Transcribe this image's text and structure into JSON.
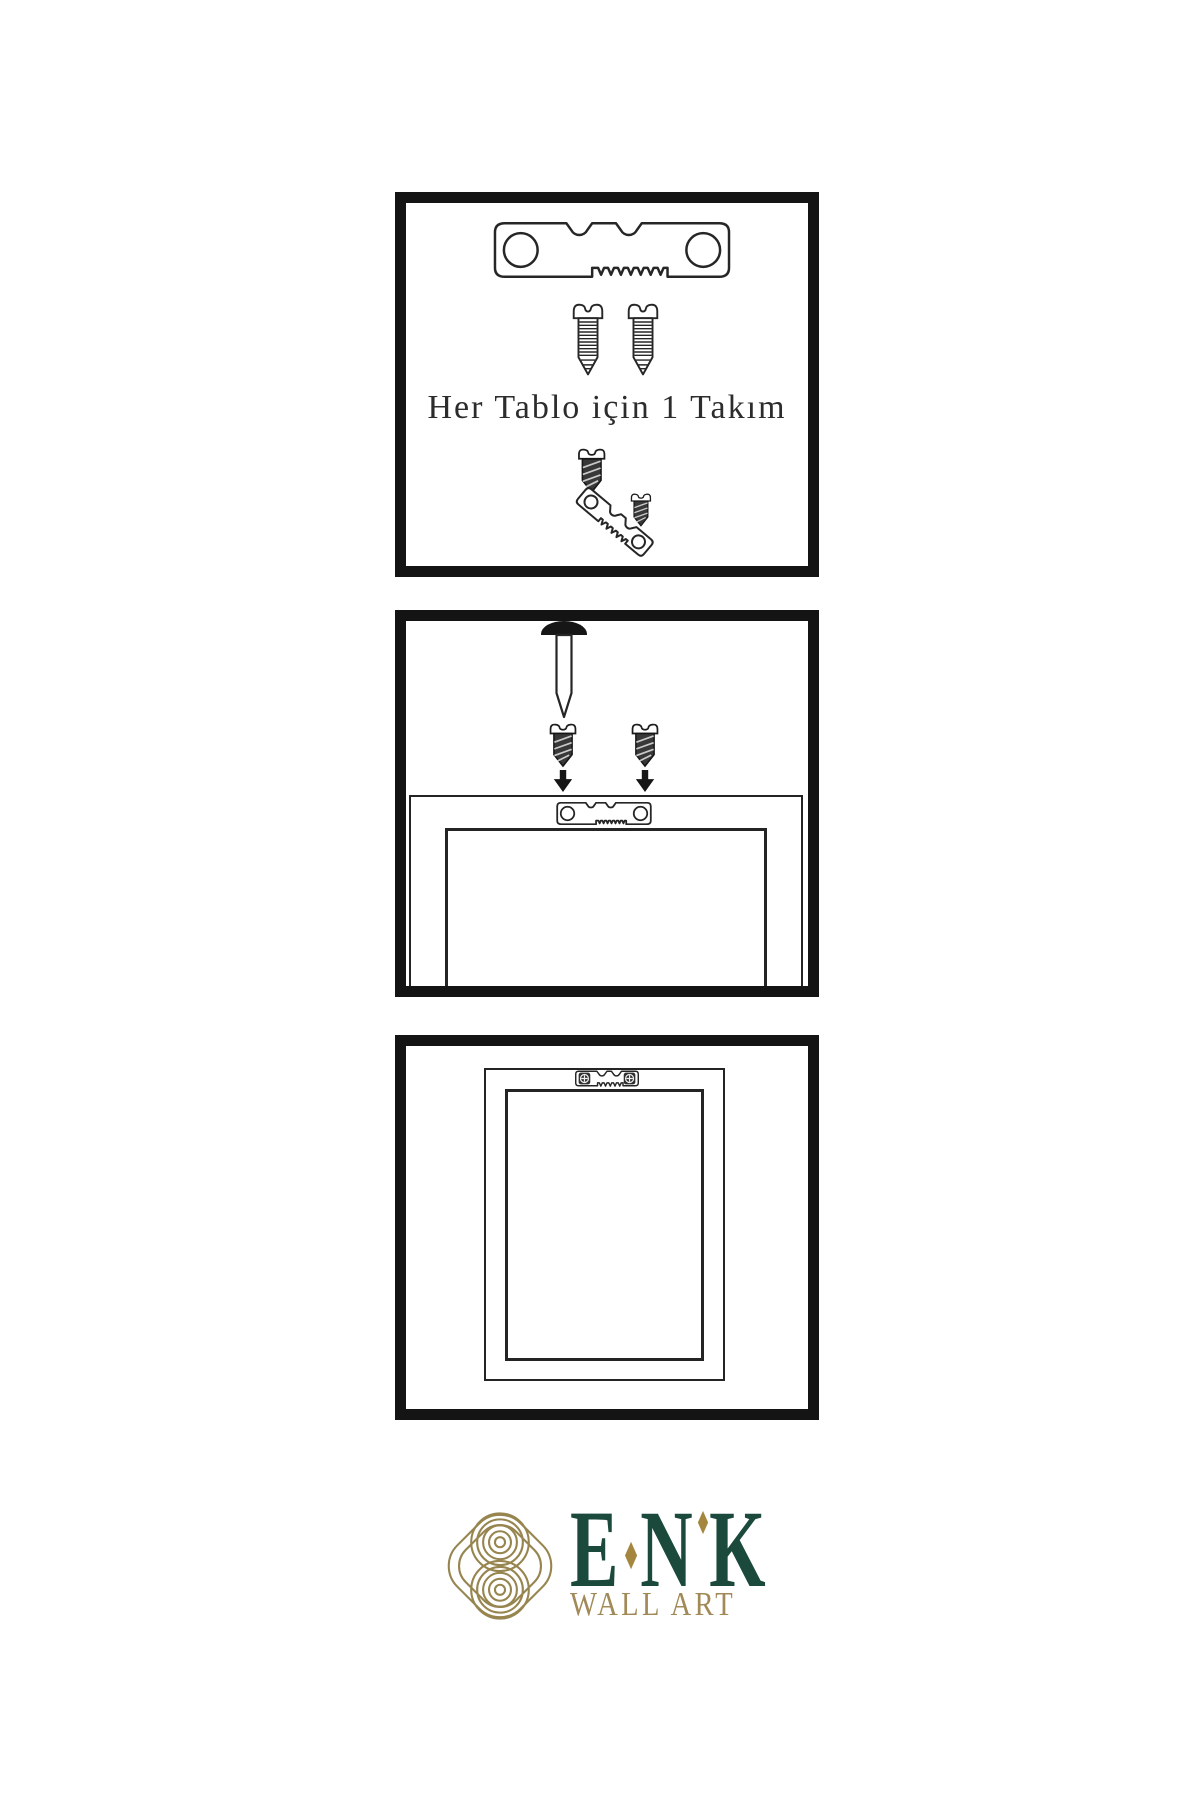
{
  "sheet": {
    "background": "#ffffff",
    "steps": [
      {
        "name": "hardware-kit",
        "caption": "Her Tablo için 1 Takım",
        "contents": [
          "sawtooth-hanger-icon",
          "screw-icon",
          "screw-icon",
          "screw-icon",
          "sawtooth-hanger-angled-icon",
          "screw-icon"
        ]
      },
      {
        "name": "attach-hanger-to-frame-back",
        "contents": [
          "nail-icon",
          "screw-icon",
          "screw-icon",
          "arrow-down-icon",
          "arrow-down-icon",
          "sawtooth-hanger-icon",
          "frame-back"
        ]
      },
      {
        "name": "frame-back-with-mounted-hanger",
        "contents": [
          "frame-back",
          "mounted-sawtooth-hanger-icon"
        ]
      }
    ]
  },
  "logo": {
    "letters": [
      "E",
      "N",
      "K"
    ],
    "subtitle": "WALL ART",
    "emblem": "knot-logo-icon"
  },
  "colors": {
    "panel_border": "#141414",
    "line_art": "#262626",
    "screw_dark_fill": "#383838",
    "caption_text": "#2c2c2c",
    "logo_green": "#1b4a3c",
    "logo_gold": "#a18a58",
    "logo_knot_gold": "#97854f",
    "logo_diamond_gold": "#a5863e",
    "background": "#ffffff"
  },
  "icons": {
    "sawtooth_hanger": "sawtooth-hanger-icon",
    "screw": "screw-icon",
    "nail": "nail-icon",
    "arrow_down": "arrow-down-icon",
    "knot_logo": "knot-logo-icon",
    "diamond": "diamond-icon"
  }
}
